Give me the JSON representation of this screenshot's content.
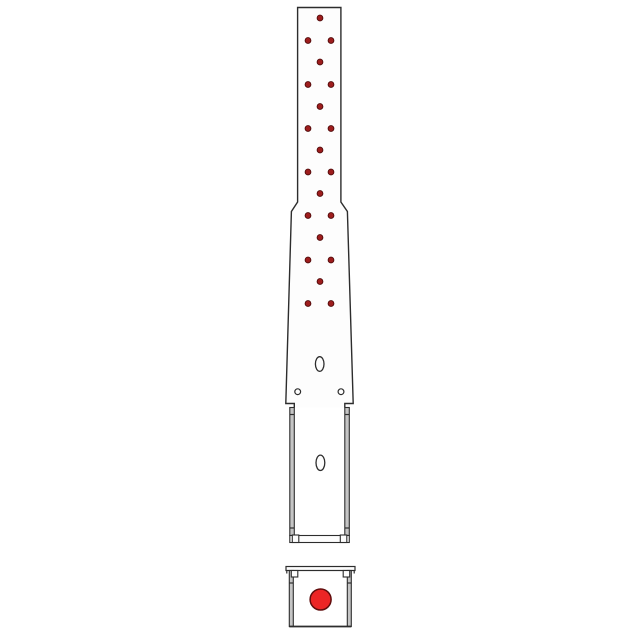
{
  "meta": {
    "background": "#ffffff",
    "canvas_width": 640,
    "canvas_height": 640,
    "description": "technical side-view drawing of tapered post anchor strap with nail holes, channel base and anchor-bolt cross-section"
  },
  "drawing": {
    "palette": {
      "line": "#2d2d2d",
      "white": "#fdfdfd",
      "wall": "#c5c5c5",
      "nail": "#9e1d1d",
      "nailEdge": "#500a0a",
      "bolt": "#ec2525",
      "boltEdge": "#5f0d0d",
      "none": "none"
    },
    "nail_holes": {
      "radius": 2.9,
      "points": [
        [
          320,
          18
        ],
        [
          308,
          40.5
        ],
        [
          331,
          40.5
        ],
        [
          320,
          62
        ],
        [
          308,
          84.5
        ],
        [
          331,
          84.5
        ],
        [
          320,
          106.5
        ],
        [
          308,
          128.5
        ],
        [
          331,
          128.5
        ],
        [
          320,
          150
        ],
        [
          308,
          172
        ],
        [
          331,
          172
        ],
        [
          320,
          193.5
        ],
        [
          308,
          215.5
        ],
        [
          331,
          215.5
        ],
        [
          320,
          237.5
        ],
        [
          308,
          260
        ],
        [
          331,
          260
        ],
        [
          320,
          281.5
        ],
        [
          308,
          303.5
        ],
        [
          331,
          303.5
        ]
      ]
    },
    "shapes": [
      {
        "t": "path",
        "n": "upper-body-outline",
        "d": "M 294.3 407.5 L 294.3 403.5 L 285.8 403.5 L 291.4 211.5 L 297.6 202 L 297.6 7.5 L 340.9 7.5 L 340.9 202 L 347.4 211.5 L 353.2 403.5 L 344.8 403.5 L 344.8 407.5",
        "f": "white",
        "s": "line",
        "w": 1.4
      },
      {
        "t": "ellipse",
        "n": "slot-hole-upper",
        "cx": 319.7,
        "cy": 364,
        "rx": 4.3,
        "ry": 7.3,
        "f": "white",
        "s": "line",
        "w": 1.3
      },
      {
        "t": "circle",
        "n": "pilot-hole-left",
        "cx": 297.7,
        "cy": 391.7,
        "r": 2.9,
        "f": "white",
        "s": "line",
        "w": 1.2
      },
      {
        "t": "circle",
        "n": "pilot-hole-right",
        "cx": 341,
        "cy": 391.7,
        "r": 2.9,
        "f": "white",
        "s": "line",
        "w": 1.2
      },
      {
        "t": "rect",
        "n": "channel-wall-left",
        "x": 289.8,
        "y": 407.5,
        "wd": 4.5,
        "ht": 128,
        "f": "wall",
        "s": "line",
        "w": 1.1
      },
      {
        "t": "rect",
        "n": "channel-wall-right",
        "x": 344.8,
        "y": 407.5,
        "wd": 4.5,
        "ht": 128,
        "f": "wall",
        "s": "line",
        "w": 1.1
      },
      {
        "t": "ellipse",
        "n": "slot-hole-lower",
        "cx": 320.4,
        "cy": 462.8,
        "rx": 4.4,
        "ry": 7.7,
        "f": "white",
        "s": "line",
        "w": 1.3
      },
      {
        "t": "rect",
        "n": "channel-bottom-plate",
        "x": 289.8,
        "y": 535.5,
        "wd": 59.5,
        "ht": 7,
        "f": "white",
        "s": "line",
        "w": 1.1
      },
      {
        "t": "rect",
        "n": "channel-bend-square-left",
        "x": 292.3,
        "y": 535,
        "wd": 6.5,
        "ht": 7.5,
        "f": "white",
        "s": "line",
        "w": 1.1
      },
      {
        "t": "rect",
        "n": "channel-bend-square-right",
        "x": 340.3,
        "y": 535,
        "wd": 6.5,
        "ht": 7.5,
        "f": "white",
        "s": "line",
        "w": 1.1
      },
      {
        "t": "line",
        "n": "channel-wall-tick-left-top",
        "x1": 289.8,
        "y1": 414.5,
        "x2": 294.3,
        "y2": 414.5,
        "s": "line",
        "w": 1.2
      },
      {
        "t": "line",
        "n": "channel-wall-tick-right-top",
        "x1": 344.8,
        "y1": 414.5,
        "x2": 349.3,
        "y2": 414.5,
        "s": "line",
        "w": 1.2
      },
      {
        "t": "line",
        "n": "channel-wall-tick-left-bottom",
        "x1": 289.8,
        "y1": 528,
        "x2": 294.3,
        "y2": 528,
        "s": "line",
        "w": 1.2
      },
      {
        "t": "line",
        "n": "channel-wall-tick-right-bottom",
        "x1": 344.8,
        "y1": 528,
        "x2": 349.3,
        "y2": 528,
        "s": "line",
        "w": 1.2
      },
      {
        "t": "rect",
        "n": "base-flange",
        "x": 286,
        "y": 566.5,
        "wd": 69,
        "ht": 4,
        "f": "white",
        "s": "line",
        "w": 1.2
      },
      {
        "t": "line",
        "n": "base-flange-lip-left",
        "x1": 286.8,
        "y1": 570.5,
        "x2": 286.8,
        "y2": 573.5,
        "s": "line",
        "w": 1.2
      },
      {
        "t": "line",
        "n": "base-flange-lip-right",
        "x1": 354.2,
        "y1": 570.5,
        "x2": 354.2,
        "y2": 573.5,
        "s": "line",
        "w": 1.2
      },
      {
        "t": "rect",
        "n": "base-wall-left",
        "x": 289.3,
        "y": 570.5,
        "wd": 4,
        "ht": 56,
        "f": "wall",
        "s": "line",
        "w": 1.1
      },
      {
        "t": "rect",
        "n": "base-wall-right",
        "x": 347.3,
        "y": 570.5,
        "wd": 4,
        "ht": 56,
        "f": "wall",
        "s": "line",
        "w": 1.1
      },
      {
        "t": "rect",
        "n": "base-bend-square-left",
        "x": 291.3,
        "y": 570.5,
        "wd": 6.5,
        "ht": 6.5,
        "f": "white",
        "s": "line",
        "w": 1.1
      },
      {
        "t": "rect",
        "n": "base-bend-square-right",
        "x": 343.2,
        "y": 570.5,
        "wd": 6.5,
        "ht": 6.5,
        "f": "white",
        "s": "line",
        "w": 1.1
      },
      {
        "t": "line",
        "n": "base-wall-tick-left",
        "x1": 289.3,
        "y1": 583,
        "x2": 293.3,
        "y2": 583,
        "s": "line",
        "w": 1.2
      },
      {
        "t": "line",
        "n": "base-wall-tick-right",
        "x1": 347.3,
        "y1": 583,
        "x2": 351.3,
        "y2": 583,
        "s": "line",
        "w": 1.2
      },
      {
        "t": "line",
        "n": "base-bottom-edge",
        "x1": 289.3,
        "y1": 626.5,
        "x2": 351.3,
        "y2": 626.5,
        "s": "line",
        "w": 1.8
      },
      {
        "t": "circle",
        "n": "anchor-bolt",
        "cx": 320.6,
        "cy": 599.5,
        "r": 10.5,
        "f": "bolt",
        "s": "boltEdge",
        "w": 1.5
      }
    ]
  }
}
